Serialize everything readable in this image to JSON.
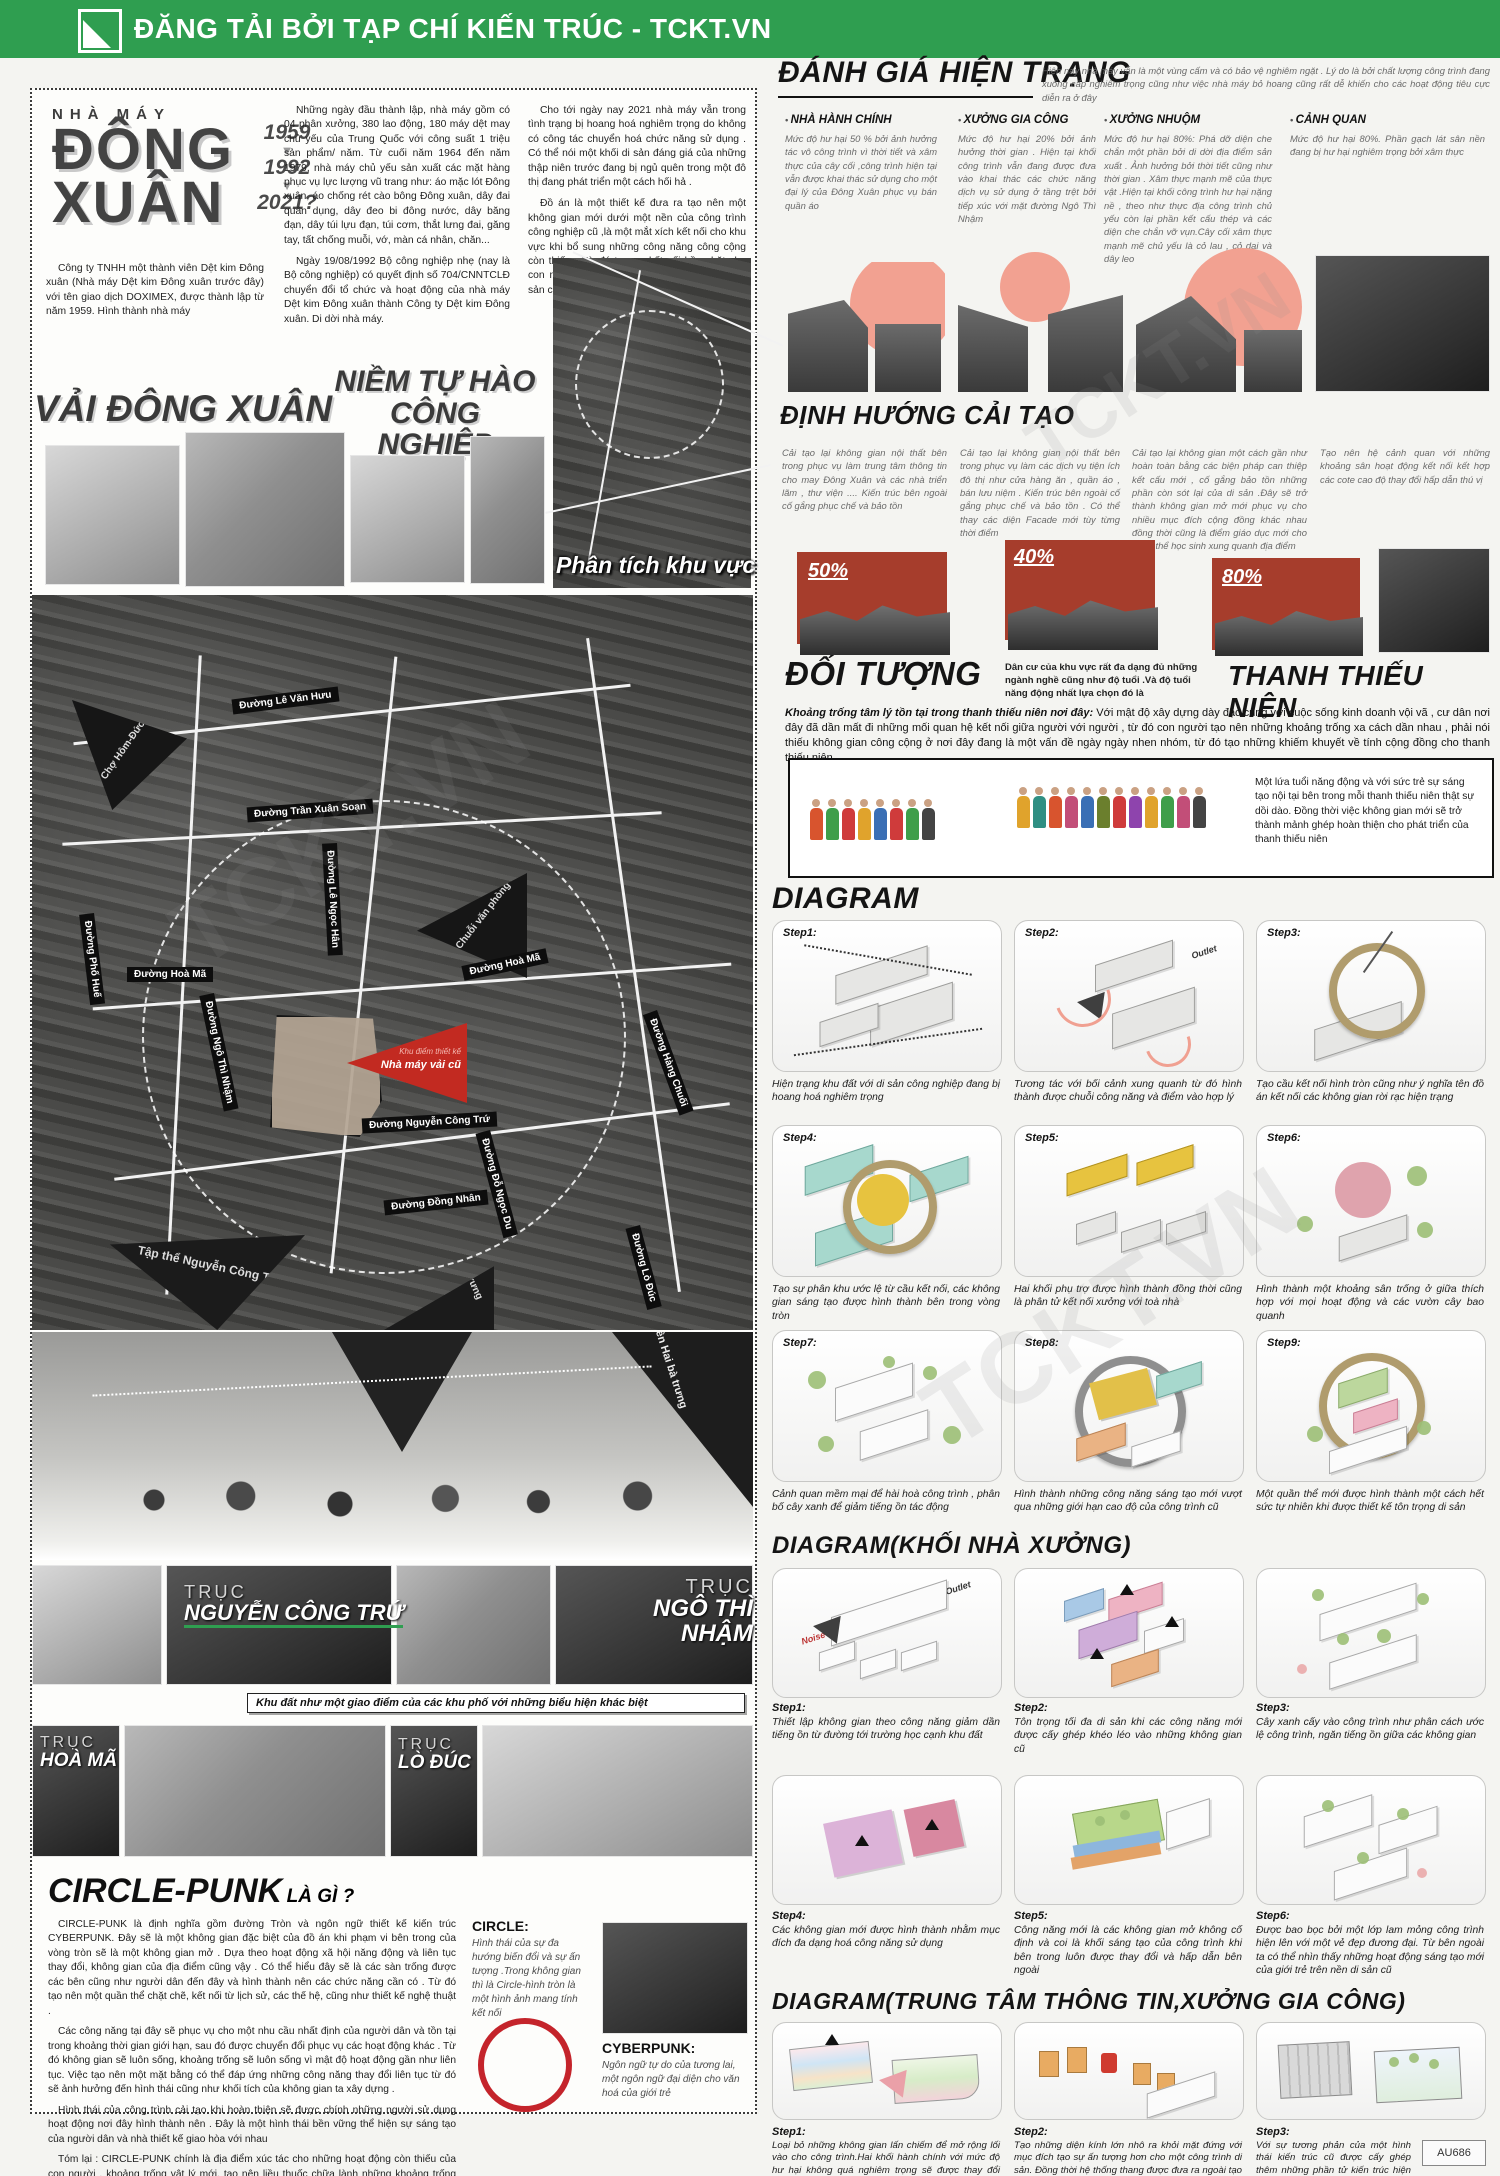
{
  "header": {
    "brand": "ĐĂNG TẢI BỞI TẠP CHÍ KIẾN TRÚC - TCKT.VN"
  },
  "watermark": {
    "text": "TCKT.VN"
  },
  "intro": {
    "factory_label": "NHÀ MÁY",
    "name1": "ĐÔNG",
    "name2": "XUÂN",
    "year1": "1959",
    "year2": "1992",
    "year3": "2021?",
    "company": "Công ty TNHH một thành viên Dệt kim Đông xuân (Nhà máy Dệt kim Đông xuân trước đây) với tên giao dịch DOXIMEX, được thành lập từ năm 1959. Hình thành nhà máy",
    "history1": "Những ngày đầu thành lập, nhà máy gồm có 04 phân xưởng, 380 lao động, 180 máy dệt may chủ yếu của Trung Quốc với công suất 1 triệu sản phẩm/ năm. Từ cuối năm 1964 đến năm 1979, nhà máy chủ yếu sản xuất các mặt hàng phục vụ lực lượng vũ trang như: áo mặc lót Đông xuân, áo chống rét cào bông Đông xuân, dây đai quân dụng, dây đeo bi đông nước, dây băng đạn, dây túi lựu đạn, túi cơm, thắt lưng đai, găng tay, tất chống muỗi, vớ, màn cá nhân, chăn...",
    "history2": "Ngày 19/08/1992 Bộ công nghiệp nhẹ (nay là Bộ công nghiệp) có quyết định số 704/CNNTCLĐ chuyển đổi tổ chức và hoạt động của nhà máy Dệt kim Đông xuân thành Công ty Dệt kim Đông xuân. Di dời nhà máy.",
    "present1": "Cho tới ngày nay 2021 nhà máy vẫn trong tình trạng bị hoang hoá nghiêm trọng do không có công tác chuyển hoá chức năng sử dụng . Có thể nói một khối di sản đáng giá của những thập niên trước đang bị ngủ quên trong một đô thị đang phát triển một cách hối hả .",
    "present2": "Đồ án là một thiết kế đưa ra tạo nên một không gian mới dưới một nền của công trình công nghiệp cũ ,là một mắt xích kết nối cho khu vực khi bổ sung những công năng công cộng còn thiếu . Từ đó tạo sự kết nối bền chặt cho con người nơi đây cũng như hồi sinh một di sản công nghiệp"
  },
  "headlines": {
    "left": "VẢI ĐÔNG XUÂN",
    "right": "NIỀM TỰ HÀO CÔNG NGHIỆP"
  },
  "analysis": {
    "label": "Phân tích khu vực"
  },
  "map": {
    "site_tag_small": "Khu điểm thiết kế",
    "site_tag": "Nhà máy vải cũ",
    "streets": [
      "Đường Lê Văn Hưu",
      "Đường Trần Xuân Soạn",
      "Đường Lê Ngọc Hân",
      "Đường Phố Huế",
      "Đường Hoà Mã",
      "Đường Hoà Mã",
      "Đường Ngô Thì Nhậm",
      "Đường Nguyễn Công Trứ",
      "Đường Đồng Nhân",
      "Đường Đỗ Ngọc Du",
      "Đường Hàng Chuối",
      "Đường Lò Đúc"
    ],
    "places": [
      "Chợ Hôm-Đức Viên",
      "Chuỗi văn phòng",
      "Tập thể Nguyễn Công Trứ",
      "Đền Hai bà trưng"
    ]
  },
  "axes": {
    "prefix": "TRỤC",
    "a1": "NGUYỄN CÔNG TRỨ",
    "a2": "NGÔ THÌ NHẬM",
    "a3": "HOÀ MÃ",
    "a4": "LÒ ĐÚC",
    "caption": "Khu đất như một giao điểm của các khu phố với những biểu hiện khác biệt"
  },
  "danhgia": {
    "title": "ĐÁNH GIÁ HIỆN TRẠNG",
    "intro": "Hiện nay nhà máy vẫn là một vùng cấm và có bảo vệ nghiêm ngặt . Lý do là bởi chất lượng công trình đang xuống cấp nghiêm trọng cũng như việc nhà máy bỏ hoang cũng rất dễ khiến cho các hoạt động tiêu cực diễn ra ở đây",
    "cols": [
      {
        "title": "NHÀ HÀNH CHÍNH",
        "text": "Mức độ hư hại 50 % bởi ảnh hưởng tác vô công trình vì thời tiết và xâm thực của cây cối ,công trình hiện tại vẫn được khai thác sử dụng cho một đại lý của Đông Xuân phục vụ bán quần áo"
      },
      {
        "title": "XƯỞNG GIA CÔNG",
        "text": "Mức độ hư hại 20% bởi ảnh hưởng thời gian . Hiện tại khối công trình vẫn đang được đưa vào khai thác các chức năng dịch vụ sử dụng ở tầng trệt bởi tiếp xúc với mặt đường Ngô Thì Nhậm"
      },
      {
        "title": "XƯỞNG NHUỘM",
        "text": "Mức độ hư hại 80%: Phá dỡ diện che chắn một phần bởi di dời địa điểm sản xuất . Ảnh hưởng bởi thời tiết cũng như thời gian . Xâm thực mạnh mẽ của thực vật .Hiện tại khối công trình hư hại nặng nề , theo như thực địa công trình chủ yếu còn lại phần kết cấu thép và các diện che chắn vỡ vụn.Cây cối xâm thực mạnh mẽ chủ yếu là cỏ lau , cỏ dại và dây leo"
      },
      {
        "title": "CẢNH QUAN",
        "text": "Mức độ hư hại 80%. Phần gạch lát sân nền đang bị hư hại nghiêm trọng bởi xâm thực"
      }
    ]
  },
  "dinhhuong": {
    "title": "ĐỊNH HƯỚNG CẢI TẠO",
    "items": [
      {
        "percent": "50%",
        "text": "Cải tạo lại không gian nội thất bên trong phục vụ làm trung tâm thông tin cho may Đông Xuân và các nhà triển lãm , thư viện .... Kiến trúc bên ngoài cố gắng phục chế và bảo tồn"
      },
      {
        "percent": "40%",
        "text": "Cải tạo lại không gian nội thất bên trong phục vụ làm các dịch vụ tiện ích đô thị như cửa hàng ăn , quần áo , bán lưu niệm . Kiến trúc bên ngoài cố gắng phục chế và bảo tồn . Có thể thay các diện Facade mới tùy từng thời điểm"
      },
      {
        "percent": "80%",
        "text": "Cải tạo lại không gian một cách gần như hoàn toàn bằng các biện pháp can thiệp kết cấu mới , cố gắng bảo tồn những phần còn sót lại của di sản .Đây sẽ trở thành không gian mở mới phục vụ cho nhiều mục đích cộng đồng khác nhau đồng thời cũng là điểm giáo dục mới cho quần thể học sinh xung quanh địa điểm"
      },
      {
        "percent": "",
        "text": "Tạo nên hệ cảnh quan với những khoảng sân hoạt động kết nối kết hợp các cote cao độ thay đổi hấp dẫn thú vị"
      }
    ]
  },
  "doituong": {
    "title": "ĐỐI TƯỢNG",
    "subtitle": "Dân cư của khu vực rất đa dạng đủ những ngành nghề cũng như độ tuổi .Và độ tuổi năng động nhất lựa chọn đó là",
    "audience": "THANH THIẾU NIÊN",
    "lead_label": "Khoảng trống tâm lý tồn tại trong thanh thiếu niên nơi đây:",
    "lead_text": "Với mật độ xây dựng dày đặc cùng với cuộc sống kinh doanh vội vã , cư dân nơi đây đã dần mất đi những mối quan hệ kết nối giữa người với người , từ đó con người tạo nên những khoảng trống xa cách dần nhau , phải nói thiếu không gian công cộng ở nơi đây đang là một vấn đề ngày ngày nhen nhóm, từ đó tạo những khiếm khuyết về tính cộng đồng cho thanh thiếu niên",
    "box_text": "Một lứa tuổi năng động và với sức trẻ sự sáng tạo nội tại bên trong mỗi thanh thiếu niên thật sự dồi dào. Đồng thời việc không gian mới sẽ trở thành mảnh ghép hoàn thiện cho phát triển của thanh thiếu niên"
  },
  "diagram1": {
    "title": "DIAGRAM",
    "steps": [
      {
        "label": "Step1:",
        "caption": "Hiện trạng khu đất với di sản công nghiệp đang bị hoang hoá nghiêm trọng"
      },
      {
        "label": "Step2:",
        "caption": "Tương tác với bối cảnh xung quanh từ đó hình thành được chuỗi công năng và điểm vào hợp lý"
      },
      {
        "label": "Step3:",
        "caption": "Tạo cầu kết nối hình tròn cũng như ý nghĩa tên đồ án kết nối các không gian rời rạc hiện trạng"
      },
      {
        "label": "Step4:",
        "caption": "Tạo sự phân khu ước lệ từ cầu kết nối, các không gian sáng tạo được hình thành bên trong vòng tròn"
      },
      {
        "label": "Step5:",
        "caption": "Hai khối phụ trợ được hình thành đồng thời cũng là phân tử kết nối xưởng với toà nhà"
      },
      {
        "label": "Step6:",
        "caption": "Hình thành một khoảng sân trống ở giữa thích hợp với mọi hoạt động và các vườn cây bao quanh"
      },
      {
        "label": "Step7:",
        "caption": "Cảnh quan mềm mại để hài hoà công trình , phân bố cây xanh để giảm tiếng ồn tác động"
      },
      {
        "label": "Step8:",
        "caption": "Hình thành những công năng sáng tạo mới vượt qua những giới hạn cao độ của công trình cũ"
      },
      {
        "label": "Step9:",
        "caption": "Một quần thể mới được hình thành một cách hết sức tự nhiên khi được thiết kế tôn trọng di sản"
      }
    ]
  },
  "diagram2": {
    "title": "DIAGRAM(KHỐI NHÀ XƯỞNG)",
    "steps": [
      {
        "label": "Step1:",
        "caption": "Thiết lập không gian theo công năng giảm dần tiếng ồn từ đường tới trường học cạnh khu đất"
      },
      {
        "label": "Step2:",
        "caption": "Tôn trọng tối đa di sản khi các công năng mới được cấy ghép khéo léo vào những không gian cũ"
      },
      {
        "label": "Step3:",
        "caption": "Cây xanh cấy vào công trình như phân cách ước lệ công trình, ngăn tiếng ồn giữa các không gian"
      },
      {
        "label": "Step4:",
        "caption": "Các không gian mới được hình thành nhằm mục đích đa dạng hoá công năng sử dụng"
      },
      {
        "label": "Step5:",
        "caption": "Công năng mới là các không gian mở không cố định và coi là khối sáng tạo của công trình khi bên trong luôn được thay đổi và hấp dẫn bên ngoài"
      },
      {
        "label": "Step6:",
        "caption": "Được bao bọc bởi một lớp lam mỏng công trình hiện lên với một vẻ đẹp đương đại. Từ bên ngoài ta có thể nhìn thấy những hoạt động sáng tạo mới của giới trẻ trên nền di sản cũ"
      }
    ]
  },
  "diagram3": {
    "title": "DIAGRAM(TRUNG TÂM THÔNG TIN,XƯỞNG GIA CÔNG)",
    "steps": [
      {
        "label": "Step1:",
        "caption": "Loại bỏ những không gian lấn chiếm để mở rộng lối vào cho công trình.Hai khối hành chính với mức độ hư hại không quá nghiêm trọng sẽ được thay đổi công năng và phục vụ thương mại vì nằm sát với mặt đường"
      },
      {
        "label": "Step2:",
        "caption": "Tạo những diện kính lớn nhô ra khỏi mặt đứng với mục đích tạo sự ấn tượng hơn cho một công trình di sản. Đồng thời hệ thống thang được đưa ra ngoài tạo sự sinh động ấn tượng cho không gian"
      },
      {
        "label": "Step3:",
        "caption": "Với sự tương phản của một hình thái kiến trúc cũ được cấy ghép thêm những phần tử kiến trúc hiện đại tạo sự ấn tượng mạnh mẽ cho công trình khi hoàn thiện"
      }
    ]
  },
  "micro": {
    "outlet": "Outlet",
    "noise": "Noise"
  },
  "circlepunk": {
    "title": "CIRCLE-PUNK",
    "question": "LÀ GÌ ?",
    "p1": "CIRCLE-PUNK là định nghĩa gồm đường Tròn và ngôn ngữ thiết kế kiến trúc CYBERPUNK. Đây sẽ là một không gian đặc biệt của đồ án khi phạm vi bên trong của vòng tròn sẽ là một không gian mở . Dựa theo hoạt động xã hội năng động và liên tục thay đổi, không gian của địa điểm cũng vậy . Có thể hiểu đây sẽ là các sàn trống được các bên cũng như người dân đến đây và hình thành nên các chức năng cần có . Từ đó tạo nên một quần thể chặt chẽ, kết nối từ lịch sử, các thế hệ, cũng như thiết kế nghệ thuật .",
    "p2": "Các công năng tại đây sẽ phục vụ cho một nhu cầu nhất định của người dân và tồn tại trong khoảng thời gian giới hạn, sau đó được chuyển đổi phục vụ các hoạt động khác . Từ đó không gian sẽ luôn sống, khoảng trống sẽ luôn sống vì mật độ hoạt động gần như liên tục. Việc tạo nên một mặt bằng có thể đáp ứng những công năng thay đổi liên tục từ đó sẽ ảnh hưởng đến hình thái cũng như khối tích của không gian ta xây dựng .",
    "p3": "Hình thái của công trình cải tạo khi hoàn thiện sẽ được chính những người sử dụng hoạt động nơi đây hình thành nên . Đây là một hình thái bền vững thể hiện sự sáng tạo của người dân và nhà thiết kế giao hòa với nhau",
    "p4": "Tóm lại : CIRCLE-PUNK chính là địa điểm xúc tác cho những hoạt động còn thiếu của con người , khoảng trống vật lý mới, tạo nên liều thuốc chữa lành những khoảng trống trong nội tâm con người .",
    "circle_label": "CIRCLE:",
    "circle_text": "Hình thái của sự đa hướng biến đổi và sự ấn tượng .Trong không gian thì là Circle-hình tròn là một hình ảnh mang tính kết nối",
    "cyber_label": "CYBERPUNK:",
    "cyber_text": "Ngôn ngữ tự do của tương lai, một ngôn ngữ đại diện cho văn hoá của giới trẻ"
  },
  "footer": {
    "code": "AU686"
  }
}
